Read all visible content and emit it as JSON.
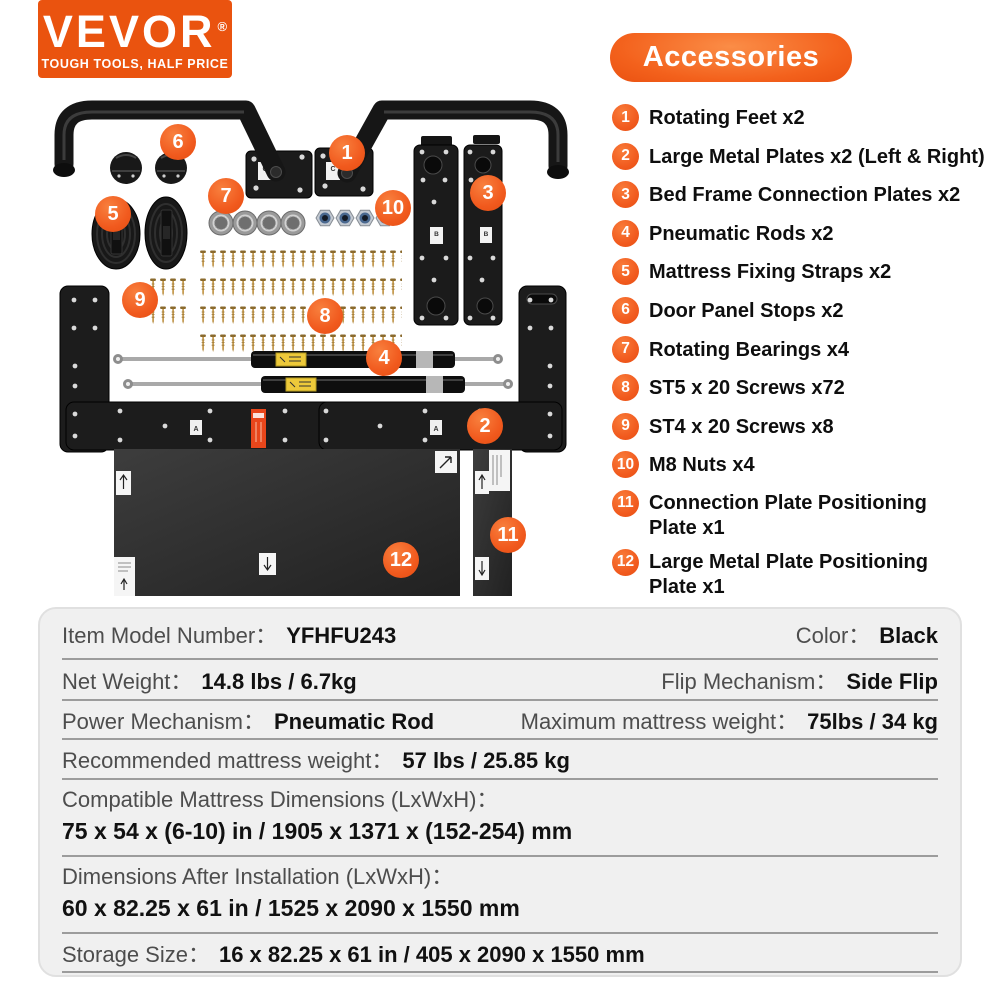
{
  "logo": {
    "brand": "VEVOR",
    "registered": "®",
    "tagline": "TOUGH TOOLS, HALF PRICE"
  },
  "accessories": {
    "title": "Accessories",
    "items": [
      {
        "number": "1",
        "label": "Rotating Feet x2"
      },
      {
        "number": "2",
        "label": "Large Metal Plates x2 (Left & Right)"
      },
      {
        "number": "3",
        "label": "Bed Frame Connection Plates x2"
      },
      {
        "number": "4",
        "label": "Pneumatic Rods x2"
      },
      {
        "number": "5",
        "label": "Mattress Fixing Straps x2"
      },
      {
        "number": "6",
        "label": "Door Panel Stops x2"
      },
      {
        "number": "7",
        "label": "Rotating Bearings x4"
      },
      {
        "number": "8",
        "label": "ST5 x 20 Screws x72"
      },
      {
        "number": "9",
        "label": "ST4 x 20 Screws x8"
      },
      {
        "number": "10",
        "label": "M8 Nuts x4"
      },
      {
        "number": "11",
        "label": "Connection Plate Positioning Plate x1"
      },
      {
        "number": "12",
        "label": "Large Metal Plate Positioning Plate x1"
      }
    ]
  },
  "diagram": {
    "part_labels": {
      "plate_c": "C",
      "plate_b": "B",
      "plate_a": "A"
    }
  },
  "specs": {
    "row1": {
      "left_label": "Item Model Number：",
      "left_value": "YFHFU243",
      "right_label": "Color：",
      "right_value": "Black"
    },
    "row2": {
      "left_label": "Net Weight：",
      "left_value": "14.8 lbs / 6.7kg",
      "right_label": "Flip Mechanism：",
      "right_value": "Side Flip"
    },
    "row3": {
      "left_label": "Power Mechanism：",
      "left_value": "Pneumatic Rod",
      "right_label": "Maximum mattress weight：",
      "right_value": "75lbs / 34 kg"
    },
    "row4": {
      "label": "Recommended mattress weight：",
      "value": "57 lbs / 25.85 kg"
    },
    "row5": {
      "label": "Compatible Mattress Dimensions (LxWxH)：",
      "value": "75 x 54 x (6-10) in / 1905 x 1371 x (152-254) mm"
    },
    "row6": {
      "label": "Dimensions After Installation (LxWxH)：",
      "value": "60 x 82.25 x 61 in / 1525 x 2090 x 1550 mm"
    },
    "row7": {
      "label": "Storage Size：",
      "value": "16 x 82.25 x 61 in / 405 x 2090 x 1550 mm"
    }
  },
  "colors": {
    "brand_orange": "#EA530F",
    "accent_orange": "#F15A1E",
    "table_background": "#F0F0F0",
    "separator_gray": "#9C9C9C",
    "label_gray": "#4D4D4D",
    "value_black": "#111111"
  }
}
